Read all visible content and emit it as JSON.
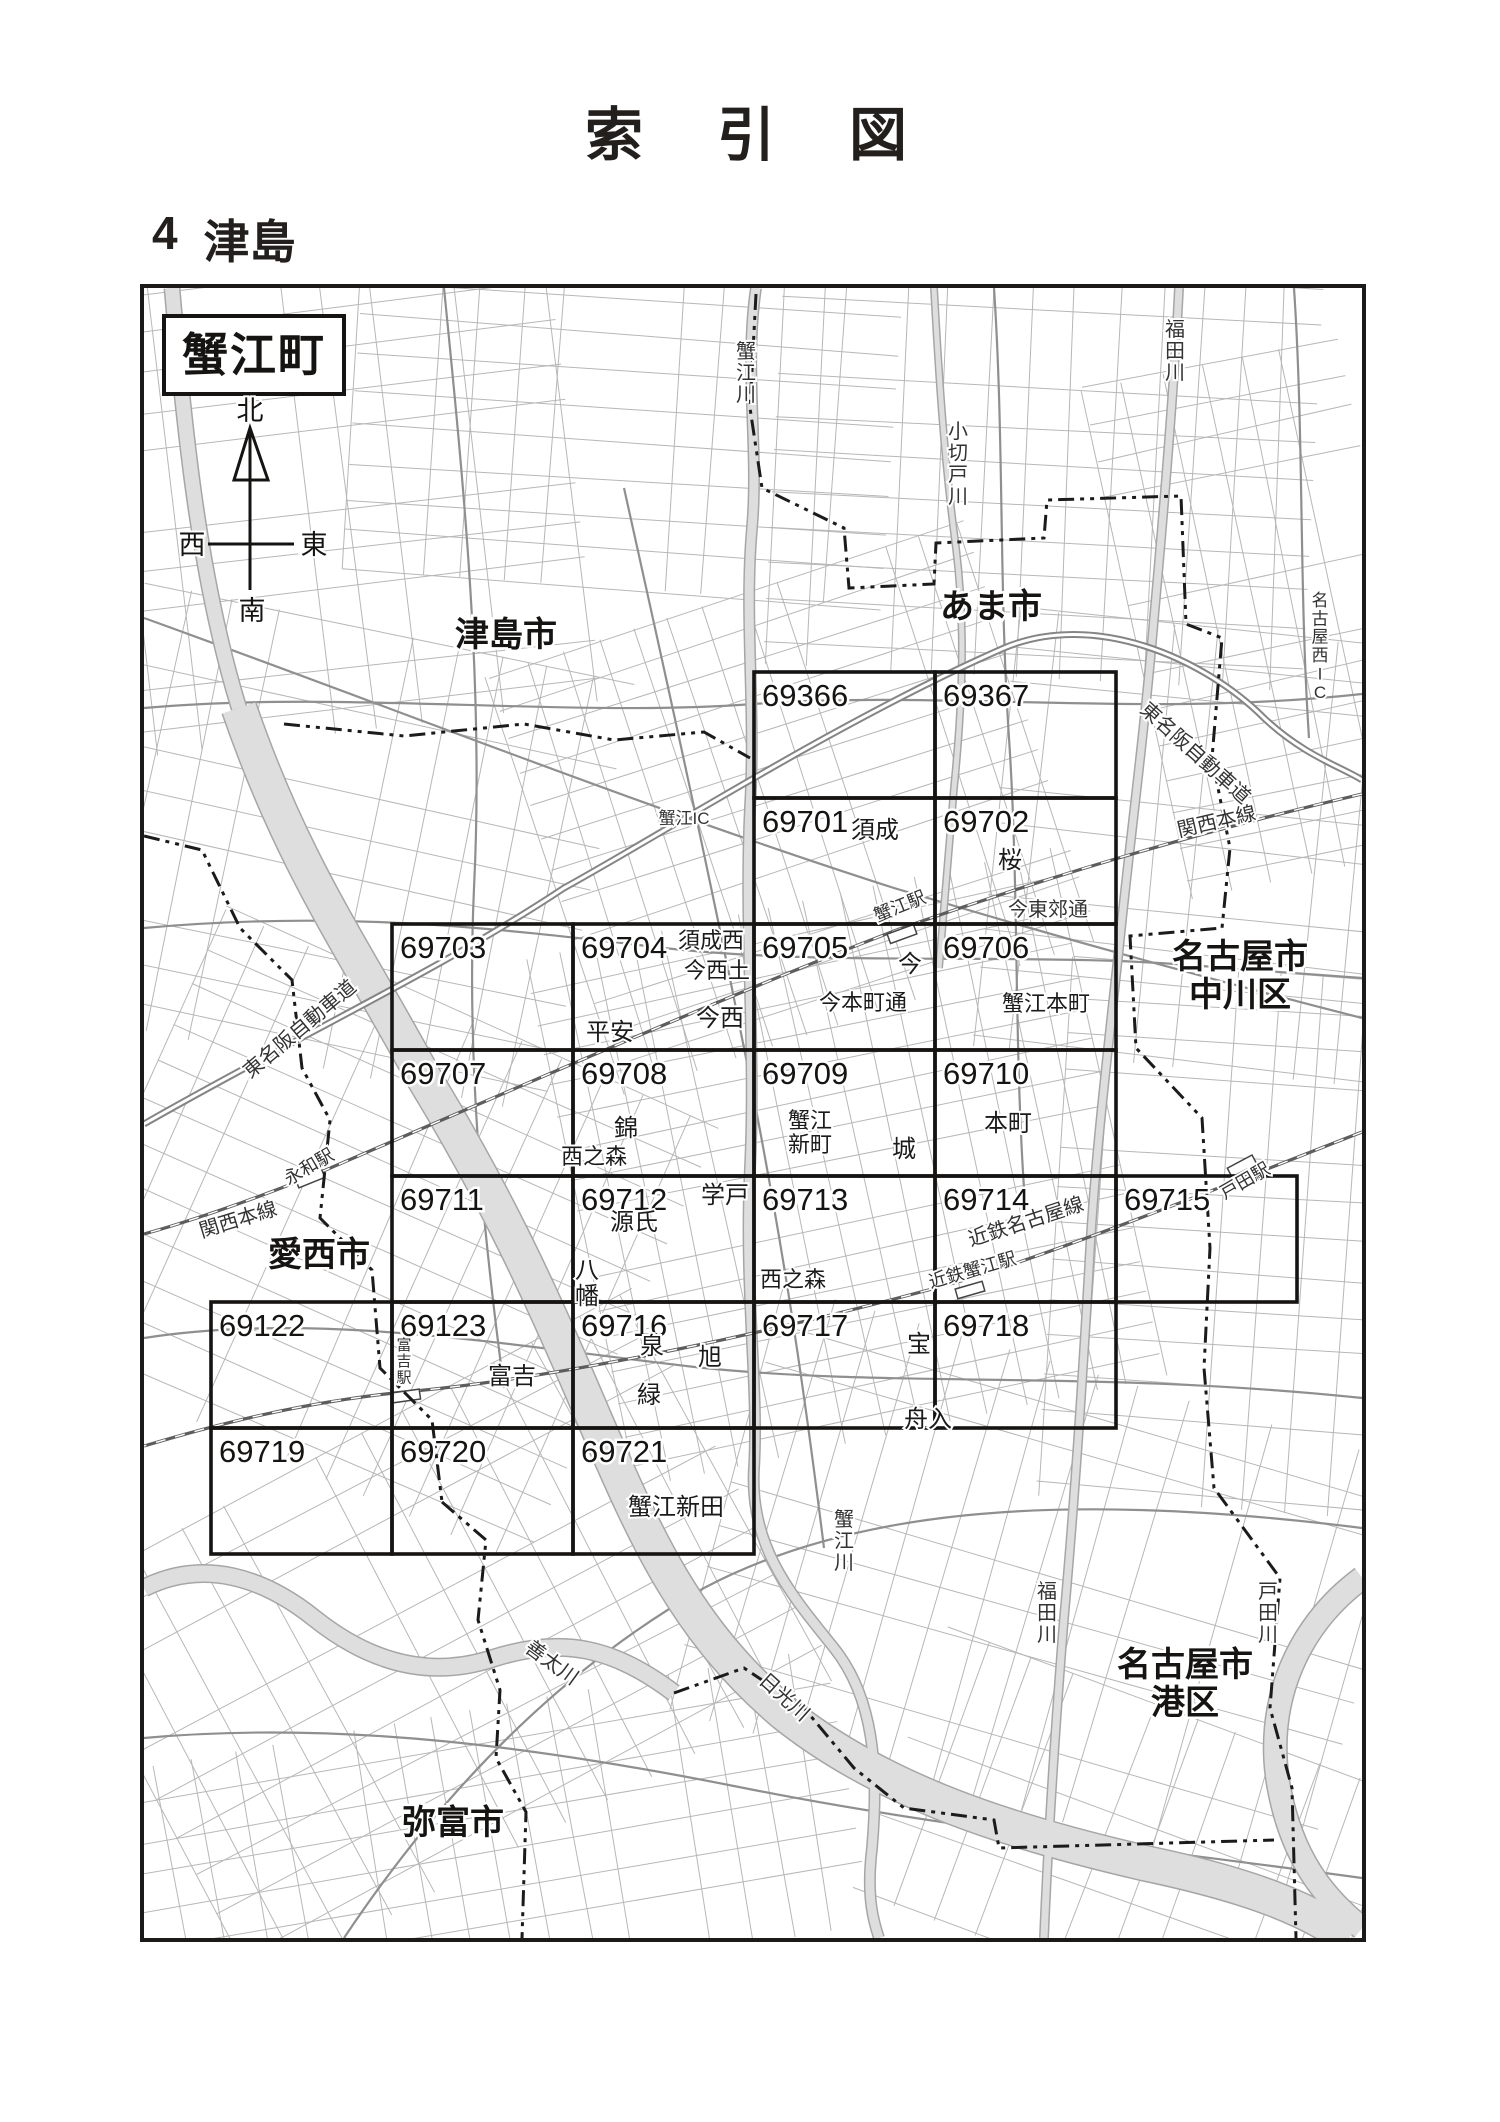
{
  "page": {
    "title": "索　引　図",
    "section_no": "4",
    "section_name": "津島"
  },
  "area_box": {
    "label": "蟹江町"
  },
  "compass": {
    "n": "北",
    "s": "南",
    "e": "東",
    "w": "西"
  },
  "map": {
    "grid": {
      "cols": 6,
      "rows": 7,
      "origin_x": 67,
      "origin_y": 384,
      "cell_w": 181,
      "cell_h": 126
    },
    "cells": [
      {
        "no": "69366",
        "col": 3,
        "row": 0
      },
      {
        "no": "69367",
        "col": 4,
        "row": 0
      },
      {
        "no": "69701",
        "col": 3,
        "row": 1
      },
      {
        "no": "69702",
        "col": 4,
        "row": 1
      },
      {
        "no": "69703",
        "col": 1,
        "row": 2
      },
      {
        "no": "69704",
        "col": 2,
        "row": 2
      },
      {
        "no": "69705",
        "col": 3,
        "row": 2
      },
      {
        "no": "69706",
        "col": 4,
        "row": 2
      },
      {
        "no": "69707",
        "col": 1,
        "row": 3
      },
      {
        "no": "69708",
        "col": 2,
        "row": 3
      },
      {
        "no": "69709",
        "col": 3,
        "row": 3
      },
      {
        "no": "69710",
        "col": 4,
        "row": 3
      },
      {
        "no": "69711",
        "col": 1,
        "row": 4
      },
      {
        "no": "69712",
        "col": 2,
        "row": 4
      },
      {
        "no": "69713",
        "col": 3,
        "row": 4
      },
      {
        "no": "69714",
        "col": 4,
        "row": 4
      },
      {
        "no": "69715",
        "col": 5,
        "row": 4
      },
      {
        "no": "69122",
        "col": 0,
        "row": 5
      },
      {
        "no": "69123",
        "col": 1,
        "row": 5
      },
      {
        "no": "69716",
        "col": 2,
        "row": 5
      },
      {
        "no": "69717",
        "col": 3,
        "row": 5
      },
      {
        "no": "69718",
        "col": 4,
        "row": 5
      },
      {
        "no": "69719",
        "col": 0,
        "row": 6
      },
      {
        "no": "69720",
        "col": 1,
        "row": 6
      },
      {
        "no": "69721",
        "col": 2,
        "row": 6
      }
    ],
    "cities": [
      {
        "lines": [
          "津島市"
        ],
        "x": 362,
        "y": 358
      },
      {
        "lines": [
          "あま市"
        ],
        "x": 847,
        "y": 330
      },
      {
        "lines": [
          "名古屋市",
          "中川区"
        ],
        "x": 1096,
        "y": 680
      },
      {
        "lines": [
          "愛西市"
        ],
        "x": 175,
        "y": 978
      },
      {
        "lines": [
          "弥富市"
        ],
        "x": 309,
        "y": 1546
      },
      {
        "lines": [
          "名古屋市",
          "港区"
        ],
        "x": 1041,
        "y": 1388
      }
    ],
    "places": [
      {
        "text": "須成",
        "x": 731,
        "y": 550
      },
      {
        "text": "桜",
        "x": 866,
        "y": 580
      },
      {
        "text": "須成西",
        "x": 567,
        "y": 660,
        "size": 22
      },
      {
        "text": "今西土",
        "x": 573,
        "y": 690,
        "size": 22
      },
      {
        "text": "今西",
        "x": 576,
        "y": 738
      },
      {
        "text": "平安",
        "x": 466,
        "y": 752
      },
      {
        "text": "今",
        "x": 766,
        "y": 684
      },
      {
        "text": "今本町通",
        "x": 719,
        "y": 722,
        "size": 22
      },
      {
        "text": "蟹江本町",
        "x": 902,
        "y": 723,
        "size": 22
      },
      {
        "text": "錦",
        "x": 482,
        "y": 848
      },
      {
        "text": "西之森",
        "x": 450,
        "y": 876,
        "size": 22
      },
      {
        "text": "蟹江",
        "x": 666,
        "y": 840,
        "size": 22
      },
      {
        "text": "新町",
        "x": 666,
        "y": 864,
        "size": 22
      },
      {
        "text": "城",
        "x": 760,
        "y": 869
      },
      {
        "text": "本町",
        "x": 864,
        "y": 843
      },
      {
        "text": "学戸",
        "x": 581,
        "y": 915
      },
      {
        "text": "源氏",
        "x": 490,
        "y": 942
      },
      {
        "text": "八幡",
        "x": 443,
        "y": 990,
        "vertical": true
      },
      {
        "text": "西之森",
        "x": 649,
        "y": 999,
        "size": 22
      },
      {
        "text": "富吉",
        "x": 368,
        "y": 1096
      },
      {
        "text": "泉",
        "x": 508,
        "y": 1066
      },
      {
        "text": "旭",
        "x": 566,
        "y": 1077
      },
      {
        "text": "緑",
        "x": 505,
        "y": 1115
      },
      {
        "text": "宝",
        "x": 775,
        "y": 1064
      },
      {
        "text": "舟入",
        "x": 784,
        "y": 1139
      },
      {
        "text": "蟹江新田",
        "x": 532,
        "y": 1227
      }
    ],
    "lines": [
      {
        "text": "蟹江川",
        "x": 602,
        "y": 70,
        "vertical": true,
        "size": 20
      },
      {
        "text": "小切戸川",
        "x": 814,
        "y": 150,
        "vertical": true,
        "size": 20
      },
      {
        "text": "福田川",
        "x": 1031,
        "y": 48,
        "vertical": true,
        "size": 20
      },
      {
        "text": "名古屋西IC",
        "x": 1176,
        "y": 318,
        "vertical": true,
        "size": 17
      },
      {
        "text": "東名阪自動車道",
        "x": 1047,
        "y": 470,
        "rot": 42,
        "size": 20
      },
      {
        "text": "関西本線",
        "x": 1074,
        "y": 540,
        "rot": -13,
        "size": 20
      },
      {
        "text": "蟹江駅",
        "x": 758,
        "y": 624,
        "rot": -22,
        "size": 18
      },
      {
        "text": "今東郊通",
        "x": 904,
        "y": 628,
        "size": 20
      },
      {
        "text": "蟹江IC",
        "x": 540,
        "y": 536,
        "size": 17
      },
      {
        "text": "東名阪自動車道",
        "x": 160,
        "y": 746,
        "rot": -40,
        "size": 20
      },
      {
        "text": "永和駅",
        "x": 168,
        "y": 884,
        "rot": -30,
        "size": 18
      },
      {
        "text": "関西本線",
        "x": 96,
        "y": 938,
        "rot": -17,
        "size": 20
      },
      {
        "text": "近鉄名古屋線",
        "x": 884,
        "y": 940,
        "rot": -18,
        "size": 20
      },
      {
        "text": "近鉄蟹江駅",
        "x": 830,
        "y": 988,
        "rot": -16,
        "size": 18
      },
      {
        "text": "戸田駅",
        "x": 1104,
        "y": 898,
        "rot": -30,
        "size": 18
      },
      {
        "text": "富吉駅",
        "x": 260,
        "y": 1062,
        "vertical": true,
        "size": 15
      },
      {
        "text": "蟹江川",
        "x": 700,
        "y": 1238,
        "vertical": true,
        "size": 20
      },
      {
        "text": "善太川",
        "x": 404,
        "y": 1380,
        "rot": 36,
        "size": 20
      },
      {
        "text": "日光川",
        "x": 636,
        "y": 1414,
        "rot": 42,
        "size": 20
      },
      {
        "text": "福田川",
        "x": 903,
        "y": 1310,
        "vertical": true,
        "size": 20
      },
      {
        "text": "戸田川",
        "x": 1124,
        "y": 1310,
        "vertical": true,
        "size": 20
      }
    ]
  }
}
